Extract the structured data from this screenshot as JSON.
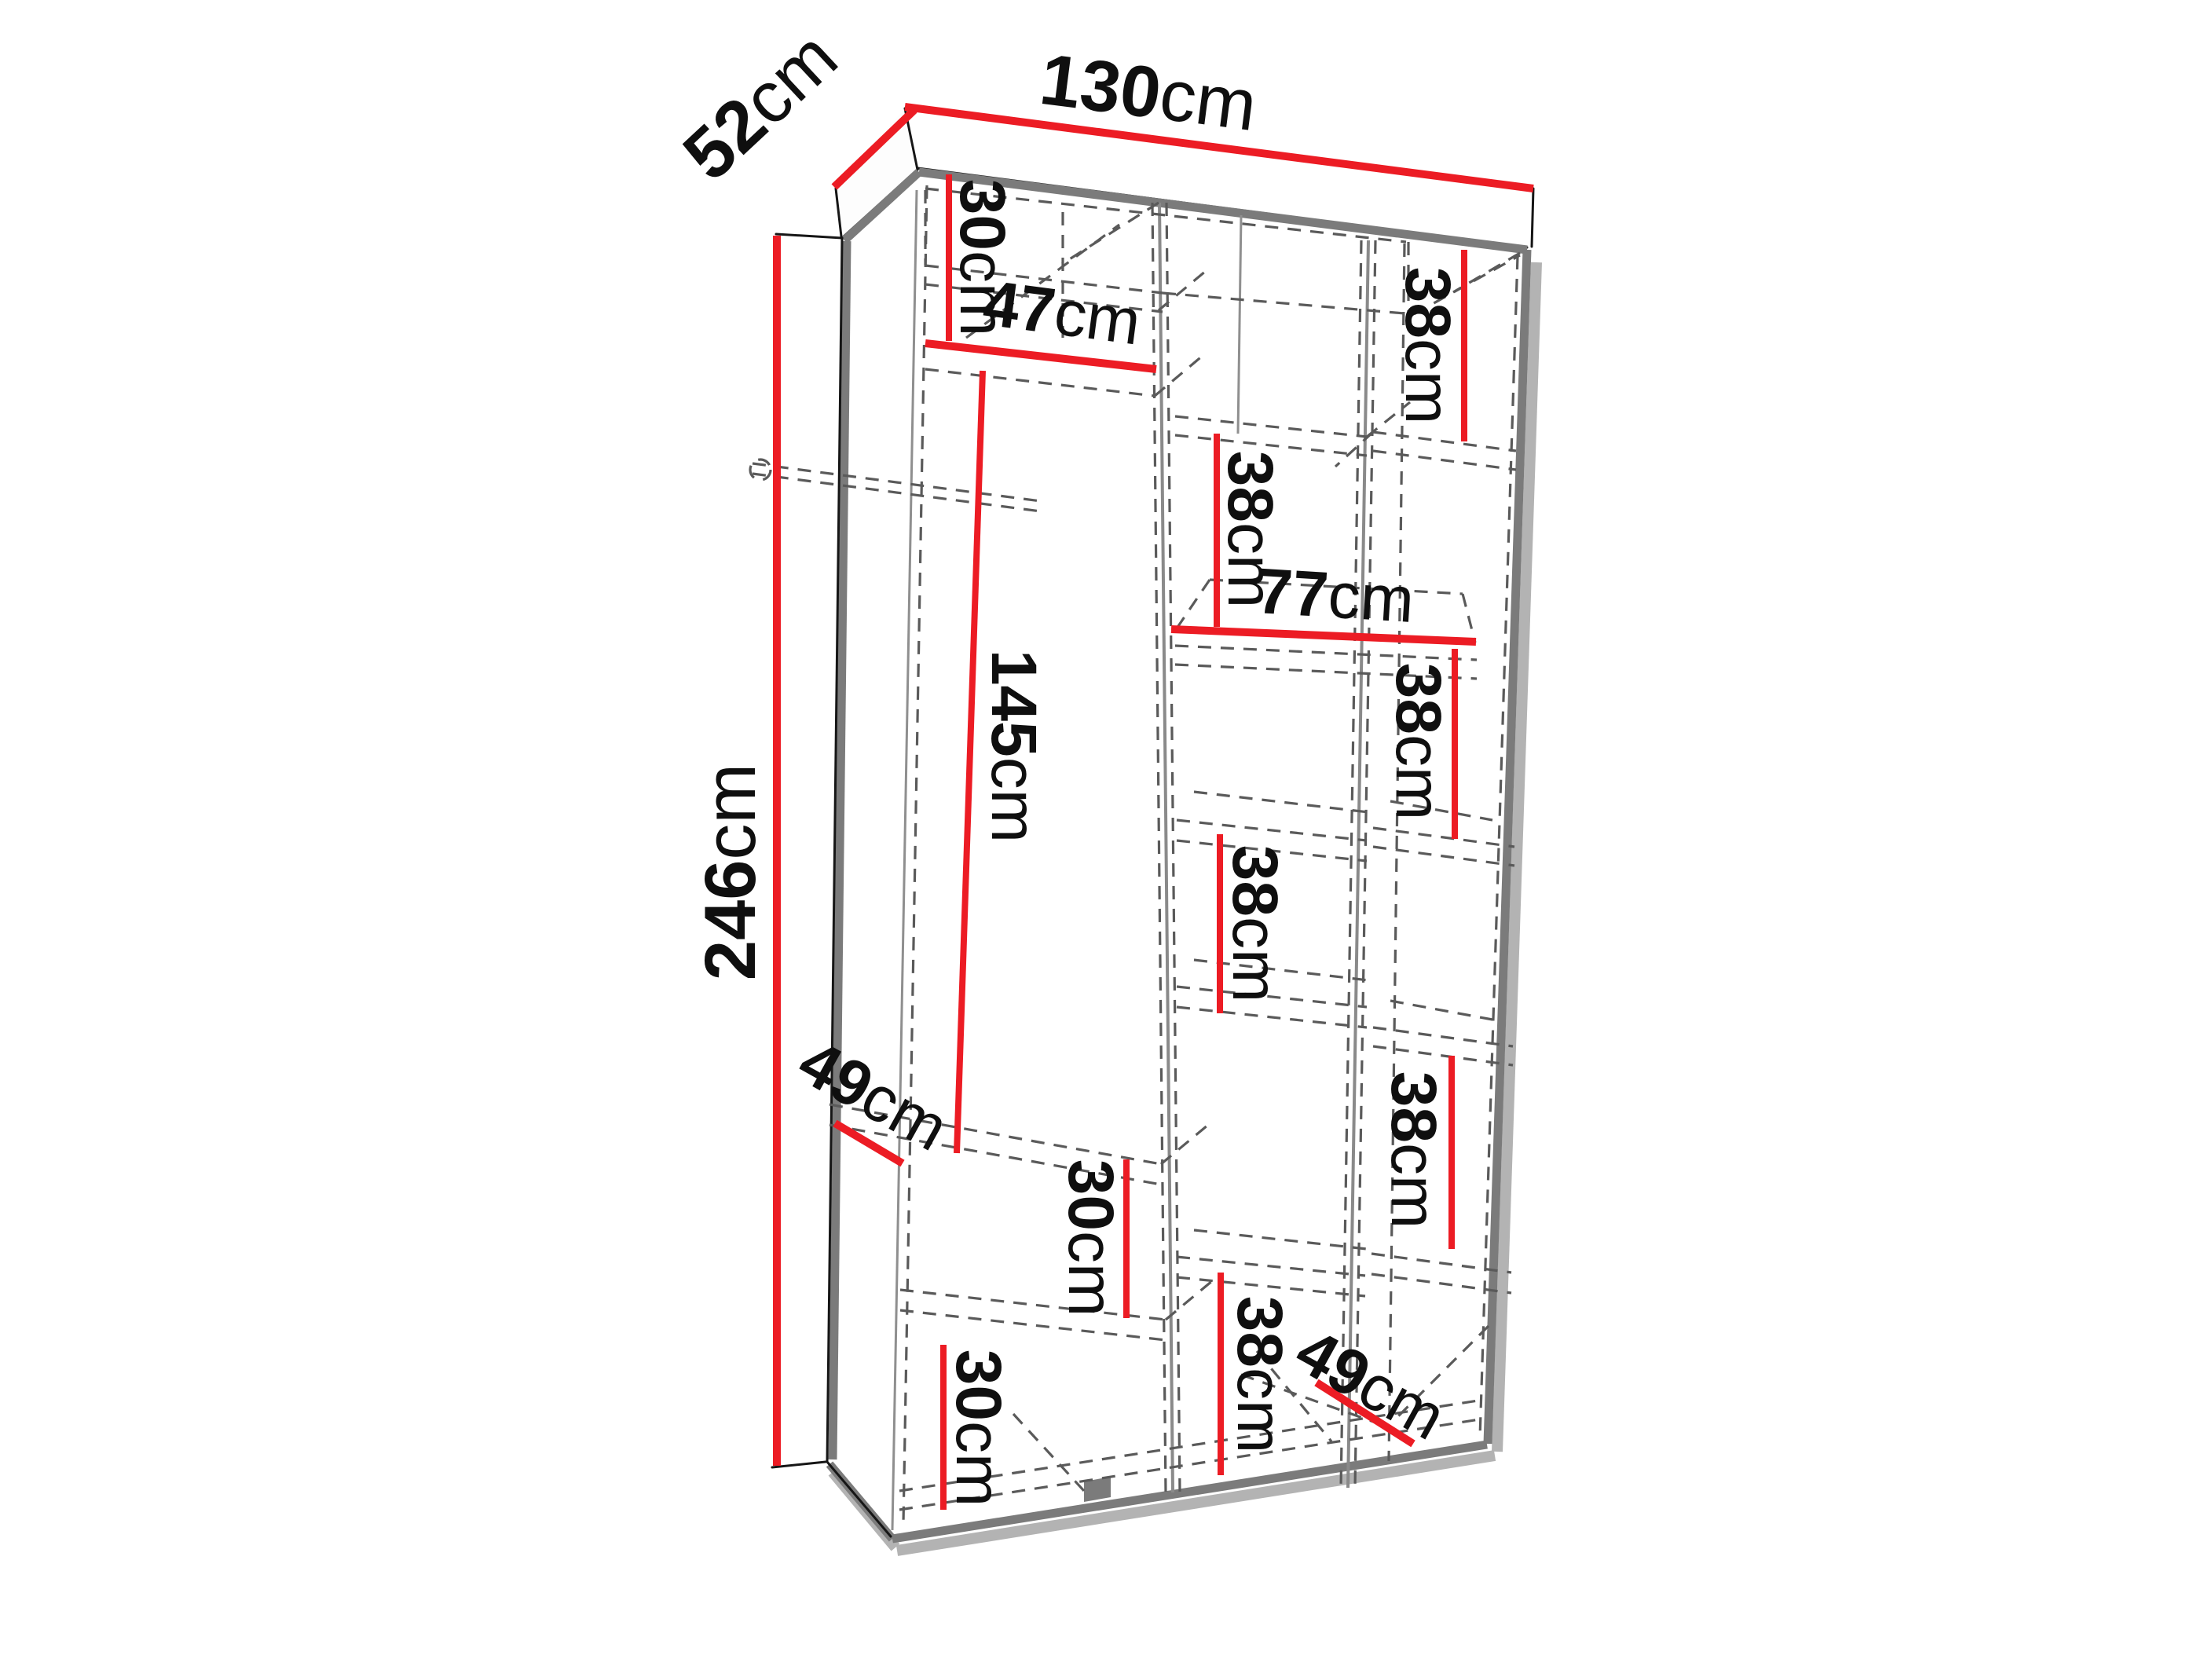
{
  "diagram": {
    "type": "furniture-dimension-drawing",
    "subject": "wardrobe interior layout, three columns with shelves and hanging space",
    "unit": "cm",
    "colors": {
      "dimension_line": "#ec1c24",
      "carcass_edge": "#7b7b7b",
      "hidden_edge_dashed": "#5a5a5a",
      "label_text": "#0f0f0f",
      "background": "#ffffff"
    },
    "overall": {
      "width": "130cm",
      "depth": "52cm",
      "height": "246cm"
    }
  },
  "dims": [
    {
      "id": "width",
      "num": "130",
      "unit": "cm"
    },
    {
      "id": "depth",
      "num": "52",
      "unit": "cm"
    },
    {
      "id": "height",
      "num": "246",
      "unit": "cm"
    },
    {
      "id": "left-top-space",
      "num": "30",
      "unit": "cm"
    },
    {
      "id": "left-shelf-width",
      "num": "47",
      "unit": "cm"
    },
    {
      "id": "left-hanging-height",
      "num": "145",
      "unit": "cm"
    },
    {
      "id": "left-shelf-depth",
      "num": "49",
      "unit": "cm"
    },
    {
      "id": "left-mid-space",
      "num": "30",
      "unit": "cm"
    },
    {
      "id": "left-bottom-space",
      "num": "30",
      "unit": "cm"
    },
    {
      "id": "middle-top-space",
      "num": "38",
      "unit": "cm"
    },
    {
      "id": "middle-shelf-width",
      "num": "77",
      "unit": "cm"
    },
    {
      "id": "middle-mid-space",
      "num": "38",
      "unit": "cm"
    },
    {
      "id": "middle-bottom-space",
      "num": "38",
      "unit": "cm"
    },
    {
      "id": "right-top-space",
      "num": "38",
      "unit": "cm"
    },
    {
      "id": "right-mid-space",
      "num": "38",
      "unit": "cm"
    },
    {
      "id": "right-low-space",
      "num": "38",
      "unit": "cm"
    },
    {
      "id": "right-shelf-depth",
      "num": "49",
      "unit": "cm"
    }
  ]
}
